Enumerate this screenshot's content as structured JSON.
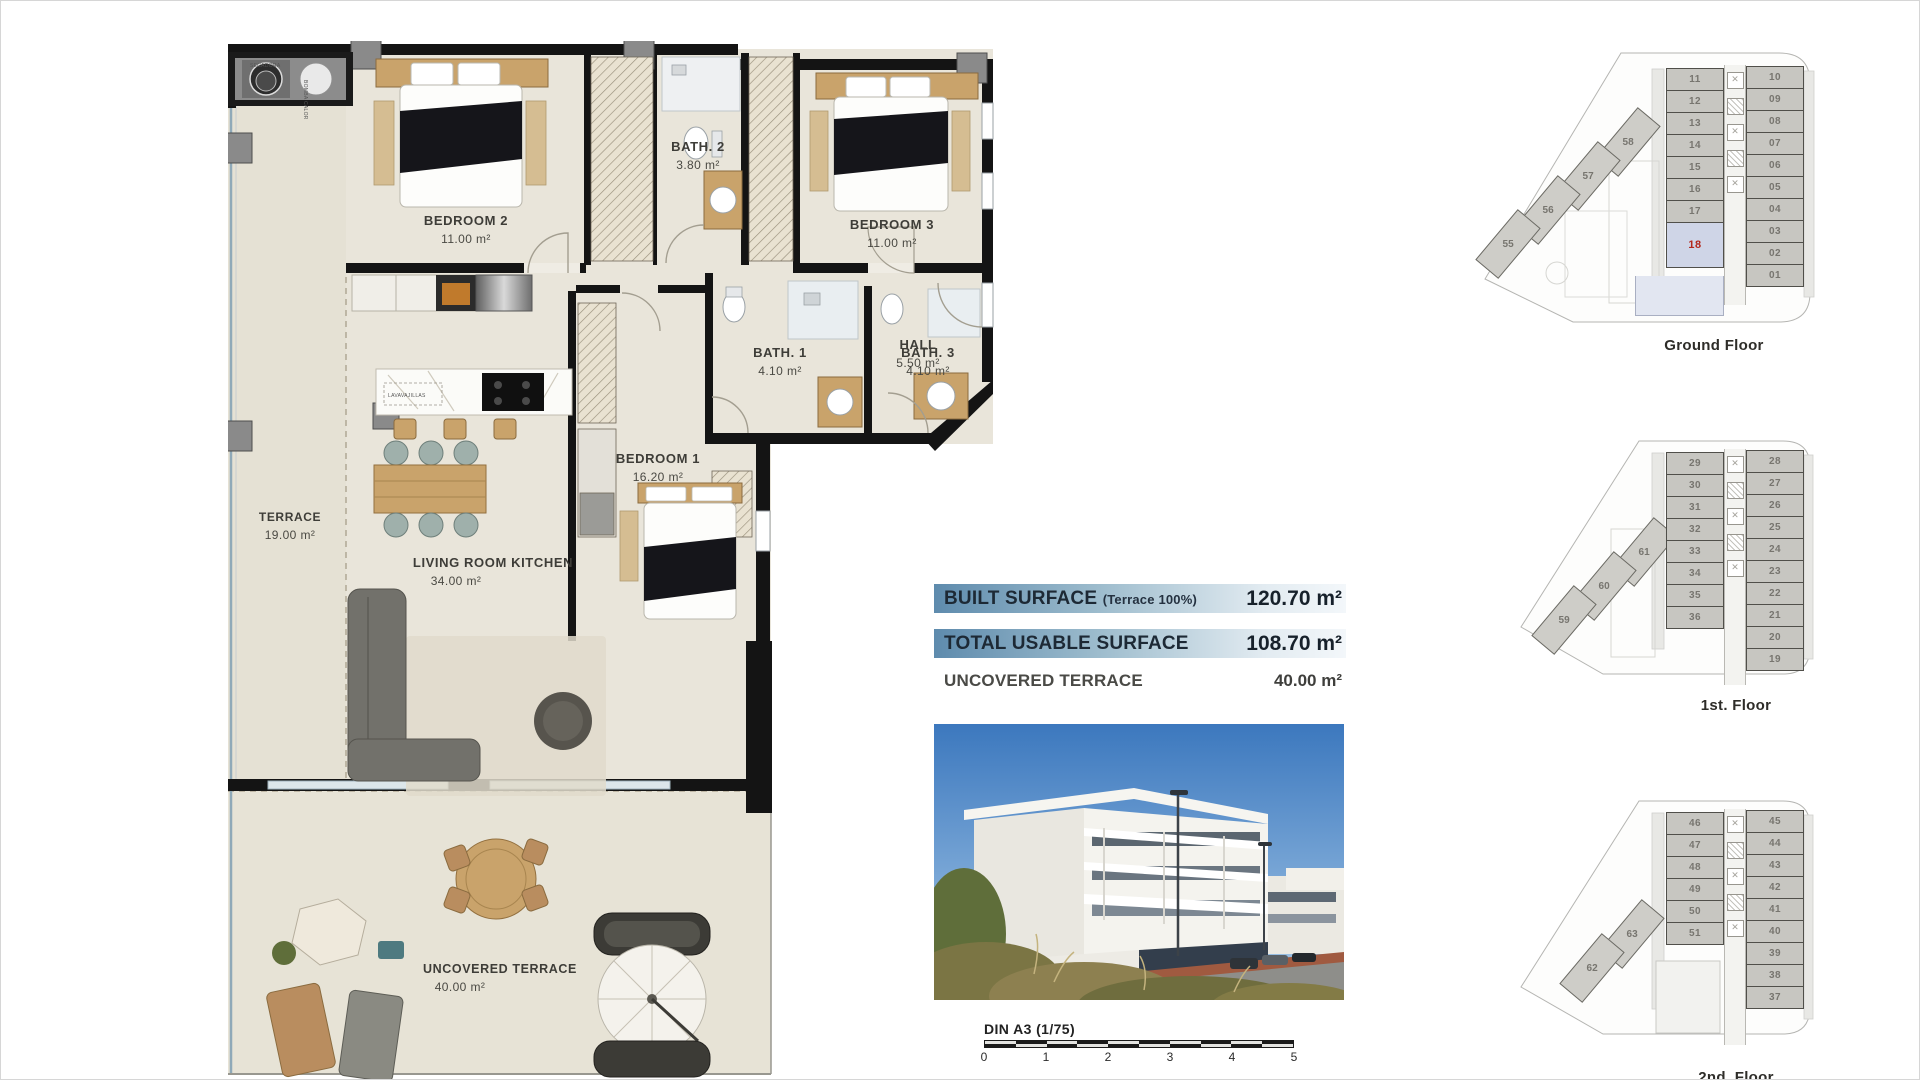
{
  "surface_table": {
    "rows": [
      {
        "label": "BUILT SURFACE",
        "note": "(Terrace 100%)",
        "value": "120.70 m²"
      },
      {
        "label": "TOTAL USABLE SURFACE",
        "note": "",
        "value": "108.70 m²"
      },
      {
        "label": "UNCOVERED TERRACE",
        "note": "",
        "value": "40.00 m²"
      }
    ]
  },
  "floorplan": {
    "rooms": [
      {
        "name": "BEDROOM 2",
        "area": "11.00 m²"
      },
      {
        "name": "BATH. 2",
        "area": "3.80 m²"
      },
      {
        "name": "BEDROOM 3",
        "area": "11.00 m²"
      },
      {
        "name": "HALL",
        "area": "5.50 m²"
      },
      {
        "name": "BATH. 1",
        "area": "4.10 m²"
      },
      {
        "name": "BATH. 3",
        "area": "4.10 m²"
      },
      {
        "name": "BEDROOM 1",
        "area": "16.20 m²"
      },
      {
        "name": "TERRACE",
        "area": "19.00 m²"
      },
      {
        "name": "LIVING ROOM KITCHEN",
        "area": "34.00 m²"
      },
      {
        "name": "UNCOVERED TERRACE",
        "area": "40.00 m²"
      }
    ],
    "equipment": {
      "dryer": "SECADORA",
      "heat_pump": "BOMBA CALOR",
      "dishwasher": "LAVAVAJILLAS"
    }
  },
  "scalebar": {
    "label": "DIN A3 (1/75)",
    "ticks": [
      "0",
      "1",
      "2",
      "3",
      "4",
      "5"
    ],
    "segments": 10
  },
  "floors": [
    {
      "label": "Ground Floor",
      "left_units": [
        "11",
        "12",
        "13",
        "14",
        "15",
        "16",
        "17"
      ],
      "highlight_unit": "18",
      "right_units": [
        "10",
        "09",
        "08",
        "07",
        "06",
        "05",
        "04",
        "03",
        "02",
        "01"
      ],
      "side_units": [
        "58",
        "57",
        "56",
        "55"
      ]
    },
    {
      "label": "1st. Floor",
      "left_units": [
        "29",
        "30",
        "31",
        "32",
        "33",
        "34",
        "35",
        "36"
      ],
      "highlight_unit": null,
      "right_units": [
        "28",
        "27",
        "26",
        "25",
        "24",
        "23",
        "22",
        "21",
        "20",
        "19"
      ],
      "side_units": [
        "61",
        "60",
        "59"
      ]
    },
    {
      "label": "2nd. Floor",
      "left_units": [
        "46",
        "47",
        "48",
        "49",
        "50",
        "51"
      ],
      "highlight_unit": null,
      "right_units": [
        "45",
        "44",
        "43",
        "42",
        "41",
        "40",
        "39",
        "38",
        "37"
      ],
      "side_units": [
        "63",
        "62"
      ]
    }
  ],
  "colors": {
    "bar_gradient_left": "#5e8bad",
    "bar_gradient_right": "#f3f7fa",
    "highlight_fill": "#cfd5e7",
    "highlight_number": "#b3271c",
    "unit_fill": "#c7c6c1",
    "wall": "#141414",
    "floor_beige": "#e9e5da"
  }
}
